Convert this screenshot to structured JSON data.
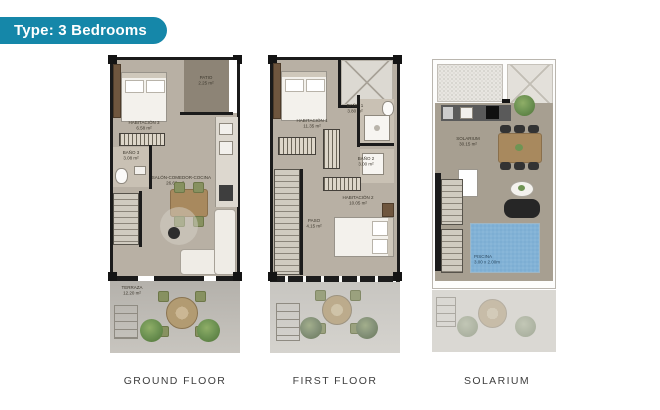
{
  "badge": {
    "label": "Type: 3 Bedrooms"
  },
  "colors": {
    "badge_bg": "#1587a9",
    "wall_black": "#1b1b1b",
    "floor_taupe": "#b8b0a4",
    "solarium_floor": "#a79f91",
    "terrace_gray": "#b4b1ab",
    "pool_blue": "#82b2d6",
    "bush_green": "#6f9454",
    "wood_brown": "#a8895e",
    "caption_gray": "#3e3e3e"
  },
  "floors": [
    {
      "caption": "GROUND FLOOR",
      "rooms": {
        "patio": {
          "name": "PATIO",
          "area": "2.25 m²"
        },
        "hab3": {
          "name": "HABITACIÓN 3",
          "area": "6.58 m²"
        },
        "bano3": {
          "name": "BAÑO 3",
          "area": "3.08 m²"
        },
        "salon": {
          "name": "SALÓN-COMEDOR-COCINA",
          "area": "26.60 m²"
        },
        "terraza": {
          "name": "TERRAZA",
          "area": "12.20 m²"
        }
      }
    },
    {
      "caption": "FIRST FLOOR",
      "rooms": {
        "hab1": {
          "name": "HABITACIÓN 1",
          "area": "11.35 m²"
        },
        "bano1": {
          "name": "BAÑO 1",
          "area": "3.80 m²"
        },
        "bano2": {
          "name": "BAÑO 2",
          "area": "3.00 m²"
        },
        "paso": {
          "name": "PASO",
          "area": "4.15 m²"
        },
        "hab2": {
          "name": "HABITACIÓN 2",
          "area": "10.05 m²"
        }
      }
    },
    {
      "caption": "SOLARIUM",
      "rooms": {
        "solarium": {
          "name": "SOLARIUM",
          "area": "30.15 m²"
        },
        "piscina": {
          "name": "PISCINA",
          "area": "3.00 x 2.00m"
        }
      }
    }
  ]
}
